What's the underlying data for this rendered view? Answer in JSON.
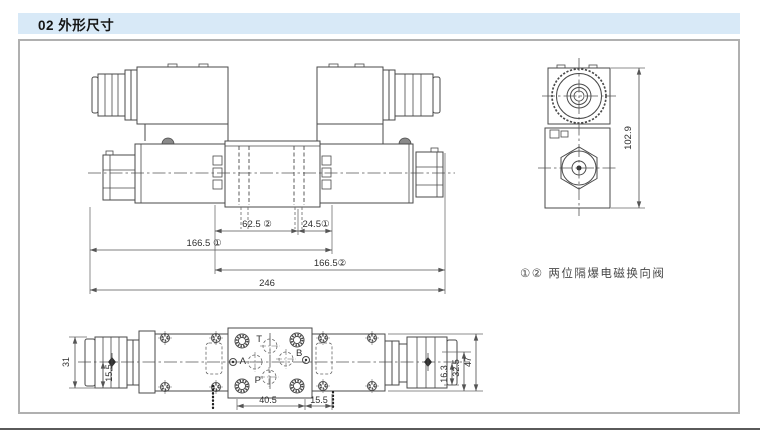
{
  "header": {
    "title": "02 外形尺寸"
  },
  "note": {
    "label": "①② 两位隔爆电磁换向阀"
  },
  "front_view": {
    "dims": {
      "spool2_offset": "62.5 ②",
      "spool1_offset": "24.5①",
      "length_sol1": "166.5 ①",
      "length_sol2": "166.5②",
      "total_length": "246"
    }
  },
  "side_view": {
    "dims": {
      "height": "102.9"
    }
  },
  "top_view": {
    "ports": {
      "t": "T",
      "a": "A",
      "b": "B",
      "p": "P"
    },
    "dims": {
      "gland_width": "31",
      "gland_half": "15.5",
      "bolt_span": "40.5",
      "bolt_offset": "15.5",
      "right_1": "16.3",
      "right_2": "32.5",
      "width_total": "47"
    }
  },
  "colors": {
    "header_bg": "#d8e9f7",
    "line": "#4a4a4a",
    "dim_text": "#2e2e2e"
  }
}
